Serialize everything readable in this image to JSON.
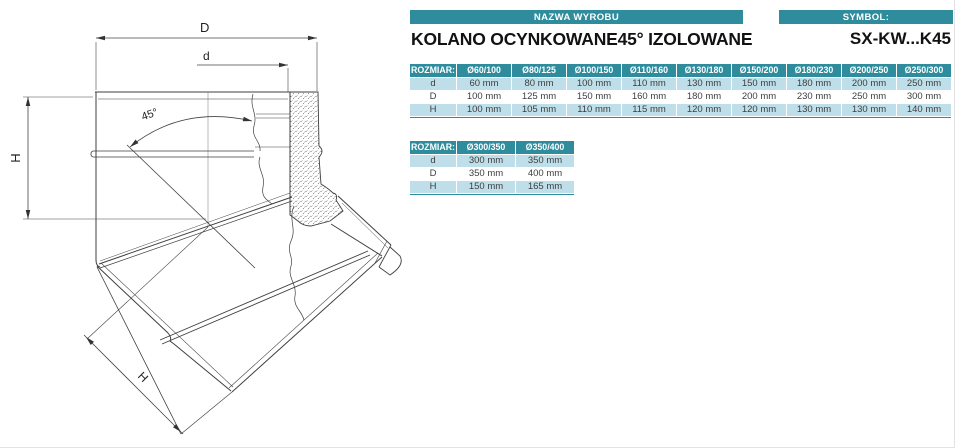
{
  "header": {
    "name_bar_label": "NAZWA WYROBU",
    "symbol_bar_label": "SYMBOL:",
    "product_name": "KOLANO OCYNKOWANE45° IZOLOWANE",
    "symbol_value": "SX-KW...K45"
  },
  "drawing": {
    "labels": {
      "outer_diameter": "D",
      "inner_diameter": "d",
      "height_vertical": "H",
      "angle": "45°",
      "height_angled": "H"
    }
  },
  "tables": [
    {
      "header_label": "ROZMIAR:",
      "columns": [
        "Ø60/100",
        "Ø80/125",
        "Ø100/150",
        "Ø110/160",
        "Ø130/180",
        "Ø150/200",
        "Ø180/230",
        "Ø200/250",
        "Ø250/300"
      ],
      "rows": [
        {
          "label": "d",
          "values": [
            "60 mm",
            "80 mm",
            "100 mm",
            "110 mm",
            "130 mm",
            "150 mm",
            "180 mm",
            "200 mm",
            "250 mm"
          ]
        },
        {
          "label": "D",
          "values": [
            "100 mm",
            "125 mm",
            "150 mm",
            "160 mm",
            "180 mm",
            "200 mm",
            "230 mm",
            "250 mm",
            "300 mm"
          ]
        },
        {
          "label": "H",
          "values": [
            "100 mm",
            "105 mm",
            "110 mm",
            "115 mm",
            "120 mm",
            "120 mm",
            "130 mm",
            "130 mm",
            "140 mm"
          ]
        }
      ]
    },
    {
      "header_label": "ROZMIAR:",
      "columns": [
        "Ø300/350",
        "Ø350/400"
      ],
      "rows": [
        {
          "label": "d",
          "values": [
            "300 mm",
            "350 mm"
          ]
        },
        {
          "label": "D",
          "values": [
            "350 mm",
            "400 mm"
          ]
        },
        {
          "label": "H",
          "values": [
            "150 mm",
            "165 mm"
          ]
        }
      ]
    }
  ],
  "colors": {
    "teal_header": "#2e8c9d",
    "row_shade": "#bedfe9"
  }
}
